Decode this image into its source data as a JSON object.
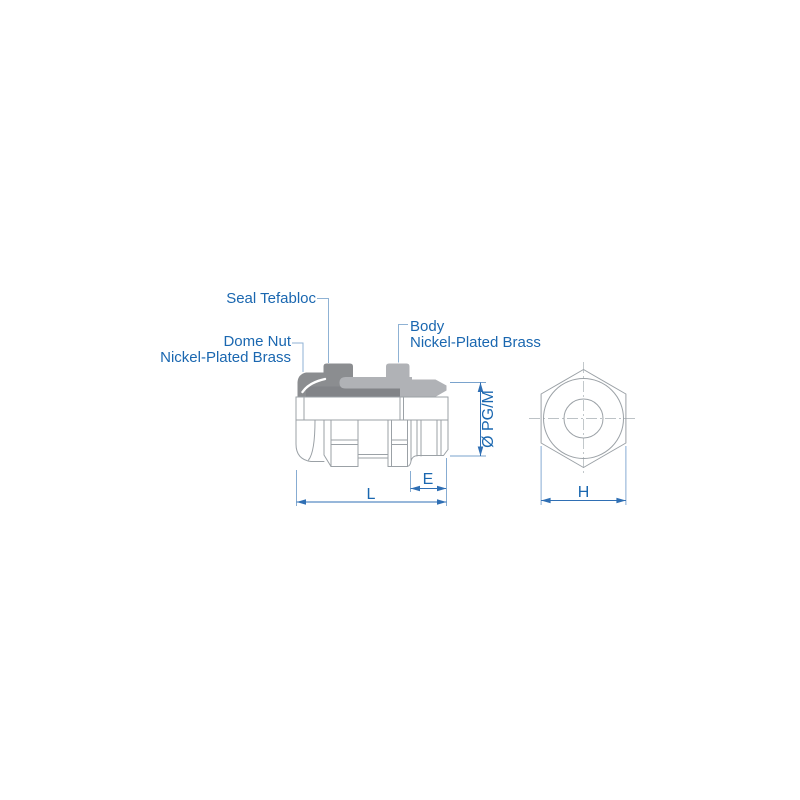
{
  "diagram": {
    "type": "technical-drawing-cable-gland",
    "labels": {
      "seal": "Seal Tefabloc",
      "dome_nut_line1": "Dome Nut",
      "dome_nut_line2": "Nickel-Plated Brass",
      "body_line1": "Body",
      "body_line2": "Nickel-Plated Brass"
    },
    "dimensions": {
      "diameter": "Ø PG/M",
      "length": "L",
      "thread_length": "E",
      "hex_width": "H"
    },
    "colors": {
      "background": "#ffffff",
      "label_text": "#1a67b0",
      "dimension": "#2f6fb4",
      "extension": "#7aa3cd",
      "leader": "#8fb2d4",
      "outline": "#9ba1a6",
      "centerline": "#bcc2c6",
      "metal_dark": "#8b8d90",
      "metal_mid": "#828488",
      "metal_light": "#b0b2b6"
    }
  }
}
